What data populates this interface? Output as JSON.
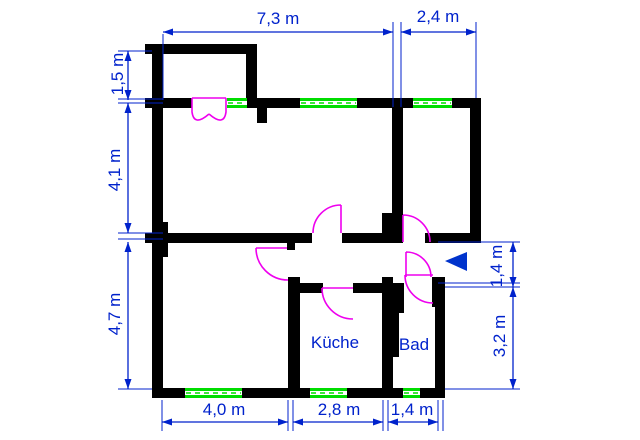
{
  "dimensions": {
    "top": [
      "7,3 m",
      "2,4 m"
    ],
    "left": [
      "1,5 m",
      "4,1 m",
      "4,7 m"
    ],
    "bottom": [
      "4,0 m",
      "2,8 m",
      "1,4 m"
    ],
    "right": [
      "1,4 m",
      "3,2 m"
    ]
  },
  "rooms": {
    "kitchen": "Küche",
    "bathroom": "Bad"
  },
  "colors": {
    "wall": "#000000",
    "window": "#00dd00",
    "window_core": "#ffffff",
    "door": "#ee00ee",
    "dimension": "#0022cc",
    "entrance_marker": "#0033cc",
    "background": "#ffffff"
  },
  "entrance_marker": {
    "shape": "triangle-left",
    "points": "445,261 467,252 467,271"
  },
  "plan": {
    "walls": [
      {
        "name": "balcony-top-wall",
        "x": 145,
        "y": 44,
        "w": 112,
        "h": 10
      },
      {
        "name": "balcony-right-wall",
        "x": 246,
        "y": 44,
        "w": 11,
        "h": 64
      },
      {
        "name": "left-exterior-wall",
        "x": 152,
        "y": 44,
        "w": 11,
        "h": 354
      },
      {
        "name": "top-wall-seg-a",
        "x": 145,
        "y": 98,
        "w": 47,
        "h": 10
      },
      {
        "name": "top-wall-seg-b",
        "x": 247,
        "y": 98,
        "w": 53,
        "h": 10
      },
      {
        "name": "top-wall-seg-c",
        "x": 357,
        "y": 98,
        "w": 56,
        "h": 10
      },
      {
        "name": "top-wall-seg-d",
        "x": 452,
        "y": 98,
        "w": 29,
        "h": 10
      },
      {
        "name": "window-pier-stub",
        "x": 257,
        "y": 107,
        "w": 10,
        "h": 16
      },
      {
        "name": "right-exterior-wall-top",
        "x": 470,
        "y": 98,
        "w": 11,
        "h": 145
      },
      {
        "name": "annex-left-wall",
        "x": 392,
        "y": 108,
        "w": 11,
        "h": 105
      },
      {
        "name": "chimney-block",
        "x": 382,
        "y": 213,
        "w": 21,
        "h": 30
      },
      {
        "name": "middle-wall-left",
        "x": 145,
        "y": 233,
        "w": 167,
        "h": 10
      },
      {
        "name": "middle-wall-stub",
        "x": 287,
        "y": 243,
        "w": 8,
        "h": 7
      },
      {
        "name": "middle-wall-right",
        "x": 342,
        "y": 233,
        "w": 40,
        "h": 10
      },
      {
        "name": "annex-bottom-wall",
        "x": 425,
        "y": 233,
        "w": 56,
        "h": 10
      },
      {
        "name": "kitchen-left-wall",
        "x": 288,
        "y": 277,
        "w": 12,
        "h": 121
      },
      {
        "name": "kitchen-top-wall-a",
        "x": 300,
        "y": 283,
        "w": 23,
        "h": 10
      },
      {
        "name": "kitchen-top-wall-b",
        "x": 353,
        "y": 283,
        "w": 29,
        "h": 10
      },
      {
        "name": "bath-west-wall",
        "x": 382,
        "y": 277,
        "w": 11,
        "h": 121
      },
      {
        "name": "bath-pilaster-upper",
        "x": 393,
        "y": 283,
        "w": 11,
        "h": 30
      },
      {
        "name": "bath-pilaster-lower",
        "x": 393,
        "y": 313,
        "w": 6,
        "h": 44
      },
      {
        "name": "bath-ne-block",
        "x": 432,
        "y": 277,
        "w": 13,
        "h": 30
      },
      {
        "name": "bath-right-wall",
        "x": 435,
        "y": 277,
        "w": 10,
        "h": 121
      },
      {
        "name": "bottom-wall-seg-a",
        "x": 152,
        "y": 388,
        "w": 33,
        "h": 10
      },
      {
        "name": "bottom-wall-seg-b",
        "x": 242,
        "y": 388,
        "w": 68,
        "h": 10
      },
      {
        "name": "bottom-wall-seg-c",
        "x": 347,
        "y": 388,
        "w": 56,
        "h": 10
      },
      {
        "name": "bottom-wall-seg-d",
        "x": 420,
        "y": 388,
        "w": 25,
        "h": 10
      },
      {
        "name": "left-wall-pilaster",
        "x": 163,
        "y": 222,
        "w": 5,
        "h": 35
      }
    ],
    "windows": [
      {
        "name": "window-top-1",
        "x": 227,
        "y": 98,
        "w": 20,
        "h": 10
      },
      {
        "name": "window-top-2",
        "x": 300,
        "y": 98,
        "w": 57,
        "h": 10
      },
      {
        "name": "window-top-3",
        "x": 413,
        "y": 98,
        "w": 39,
        "h": 10
      },
      {
        "name": "window-bottom-livingroom",
        "x": 185,
        "y": 388,
        "w": 57,
        "h": 10
      },
      {
        "name": "window-bottom-kitchen",
        "x": 310,
        "y": 388,
        "w": 37,
        "h": 10
      },
      {
        "name": "window-bottom-bath",
        "x": 403,
        "y": 388,
        "w": 17,
        "h": 10
      }
    ],
    "doors": [
      {
        "name": "french-door-left-leaf",
        "path": "M192,98 L226,98 M192,98 V112 Q194,127 209,114"
      },
      {
        "name": "french-door-right-leaf",
        "path": "M226,98 V112 Q224,127 209,114"
      },
      {
        "name": "livingroom-door",
        "path": "M256,248 H287 M256,248 A32,32 0 0 0 288,280"
      },
      {
        "name": "room-top-door",
        "path": "M341,233 V205 M313,233 A28,28 0 0 1 341,205"
      },
      {
        "name": "annex-door",
        "path": "M403,242 V215 M403,215 A27,27 0 0 1 430,242"
      },
      {
        "name": "entry-door",
        "path": "M406,277 V252 M406,252 A25,25 0 0 1 431,277"
      },
      {
        "name": "kitchen-door",
        "path": "M353,288 H322 M322,288 A31,31 0 0 0 353,319"
      },
      {
        "name": "bath-door",
        "path": "M433,275 H405 M405,275 A28,28 0 0 0 433,303"
      }
    ],
    "dimension_lines": [
      {
        "name": "dim-line-top-width",
        "x1": 163,
        "y1": 32,
        "x2": 393,
        "y2": 32
      },
      {
        "name": "dim-line-annex-width",
        "x1": 401,
        "y1": 32,
        "x2": 476,
        "y2": 32
      },
      {
        "name": "dim-line-balcony-depth",
        "x1": 128,
        "y1": 51,
        "x2": 128,
        "y2": 100
      },
      {
        "name": "dim-line-room1-height",
        "x1": 128,
        "y1": 103,
        "x2": 128,
        "y2": 233
      },
      {
        "name": "dim-line-room2-height",
        "x1": 128,
        "y1": 242,
        "x2": 128,
        "y2": 389
      },
      {
        "name": "dim-line-livingroom-width",
        "x1": 162,
        "y1": 422,
        "x2": 288,
        "y2": 422
      },
      {
        "name": "dim-line-kitchen-width",
        "x1": 293,
        "y1": 422,
        "x2": 383,
        "y2": 422
      },
      {
        "name": "dim-line-bath-width",
        "x1": 388,
        "y1": 422,
        "x2": 438,
        "y2": 422
      },
      {
        "name": "dim-line-entrance-height",
        "x1": 513,
        "y1": 242,
        "x2": 513,
        "y2": 287
      },
      {
        "name": "dim-line-bath-height",
        "x1": 513,
        "y1": 287,
        "x2": 513,
        "y2": 389
      }
    ],
    "extension_lines": [
      {
        "x1": 163,
        "y1": 34,
        "x2": 163,
        "y2": 100
      },
      {
        "x1": 393,
        "y1": 22,
        "x2": 393,
        "y2": 107
      },
      {
        "x1": 401,
        "y1": 22,
        "x2": 401,
        "y2": 107
      },
      {
        "x1": 476,
        "y1": 22,
        "x2": 476,
        "y2": 98
      },
      {
        "x1": 118,
        "y1": 51,
        "x2": 152,
        "y2": 51
      },
      {
        "x1": 118,
        "y1": 99,
        "x2": 163,
        "y2": 99
      },
      {
        "x1": 118,
        "y1": 103,
        "x2": 163,
        "y2": 103
      },
      {
        "x1": 118,
        "y1": 233,
        "x2": 163,
        "y2": 233
      },
      {
        "x1": 118,
        "y1": 239,
        "x2": 163,
        "y2": 239
      },
      {
        "x1": 118,
        "y1": 389,
        "x2": 152,
        "y2": 389
      },
      {
        "x1": 162,
        "y1": 400,
        "x2": 162,
        "y2": 431
      },
      {
        "x1": 288,
        "y1": 400,
        "x2": 288,
        "y2": 431
      },
      {
        "x1": 293,
        "y1": 400,
        "x2": 293,
        "y2": 431
      },
      {
        "x1": 383,
        "y1": 400,
        "x2": 383,
        "y2": 431
      },
      {
        "x1": 388,
        "y1": 400,
        "x2": 388,
        "y2": 431
      },
      {
        "x1": 438,
        "y1": 400,
        "x2": 438,
        "y2": 431
      },
      {
        "x1": 443,
        "y1": 400,
        "x2": 443,
        "y2": 431
      },
      {
        "x1": 438,
        "y1": 242,
        "x2": 520,
        "y2": 242
      },
      {
        "x1": 438,
        "y1": 283,
        "x2": 520,
        "y2": 283
      },
      {
        "x1": 445,
        "y1": 287,
        "x2": 520,
        "y2": 287
      },
      {
        "x1": 445,
        "y1": 389,
        "x2": 520,
        "y2": 389
      }
    ]
  }
}
